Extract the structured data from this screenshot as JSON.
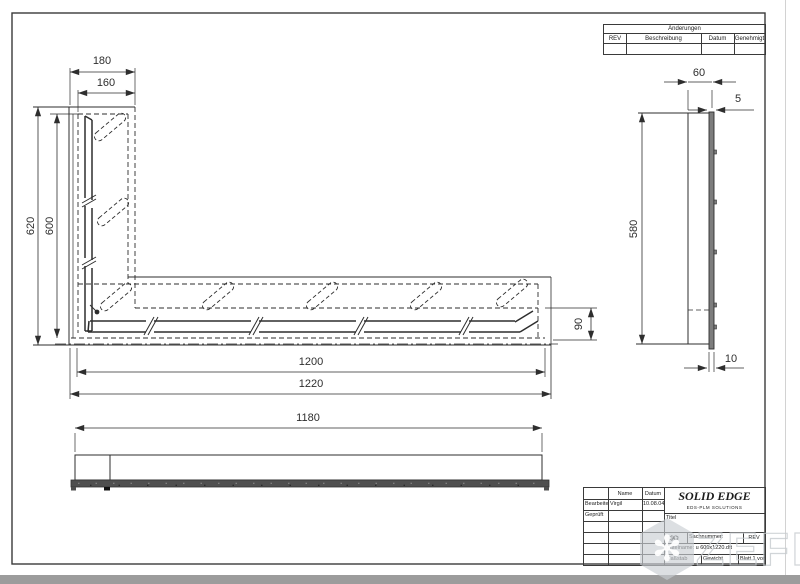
{
  "revision_table": {
    "title": "Änderungen",
    "col_rev": "REV",
    "col_desc": "Beschreibung",
    "col_date": "Datum",
    "col_approved": "Genehmigt"
  },
  "dims": {
    "w_outer": "180",
    "w_inner": "160",
    "h_outer": "620",
    "h_inner": "600",
    "flange": "90",
    "len_inner": "1200",
    "len_outer": "1220",
    "front_len": "1180",
    "depth": "60",
    "thickness": "5",
    "side_height": "580",
    "foot": "10"
  },
  "title_block": {
    "name_col": "Name",
    "date_col": "Datum",
    "drawn_label": "Bearbeitet",
    "checked_label": "Geprüft",
    "drawn_name": "Virgil",
    "drawn_date": "10.08.04",
    "logo": "SOLID EDGE",
    "logo_sub": "EDS-PLM SOLUTIONS",
    "title_label": "Titel",
    "sheet_size": "A2",
    "docnum_label": "Sachnummer:",
    "rev_label": "REV",
    "filename": "Dateiname: u 600x1220.dft",
    "scale_label": "Maßstab",
    "weight_label": "Gewicht",
    "sheet_label": "Blatt 1 von 1"
  },
  "watermark": {
    "text": "ZEFIRE"
  }
}
